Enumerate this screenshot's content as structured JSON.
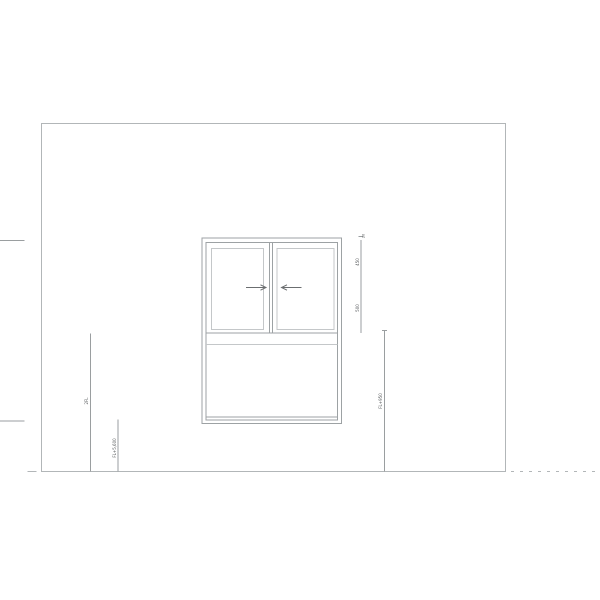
{
  "colors": {
    "wall_line": "#b2b6b8",
    "window_line": "#9da2a4",
    "light_line": "#c4c7c9",
    "annotation_line": "#9a9ea0",
    "marks": "#6b6e70",
    "text": "#55585a",
    "background": "#ffffff"
  },
  "dimension_chain": {
    "top_offset": "20",
    "upper_segment": "450",
    "lower_segment": "500"
  },
  "leader_labels": {
    "wall_left": "2FL",
    "sill_left": "FL+5,600",
    "window_right": "FL+950"
  },
  "window": {
    "left_sash_icon": "arrow-right",
    "right_sash_icon": "arrow-left",
    "panes": 2,
    "sections": [
      "sliding-sash-pair",
      "meeting-rail",
      "lower-panel"
    ]
  }
}
